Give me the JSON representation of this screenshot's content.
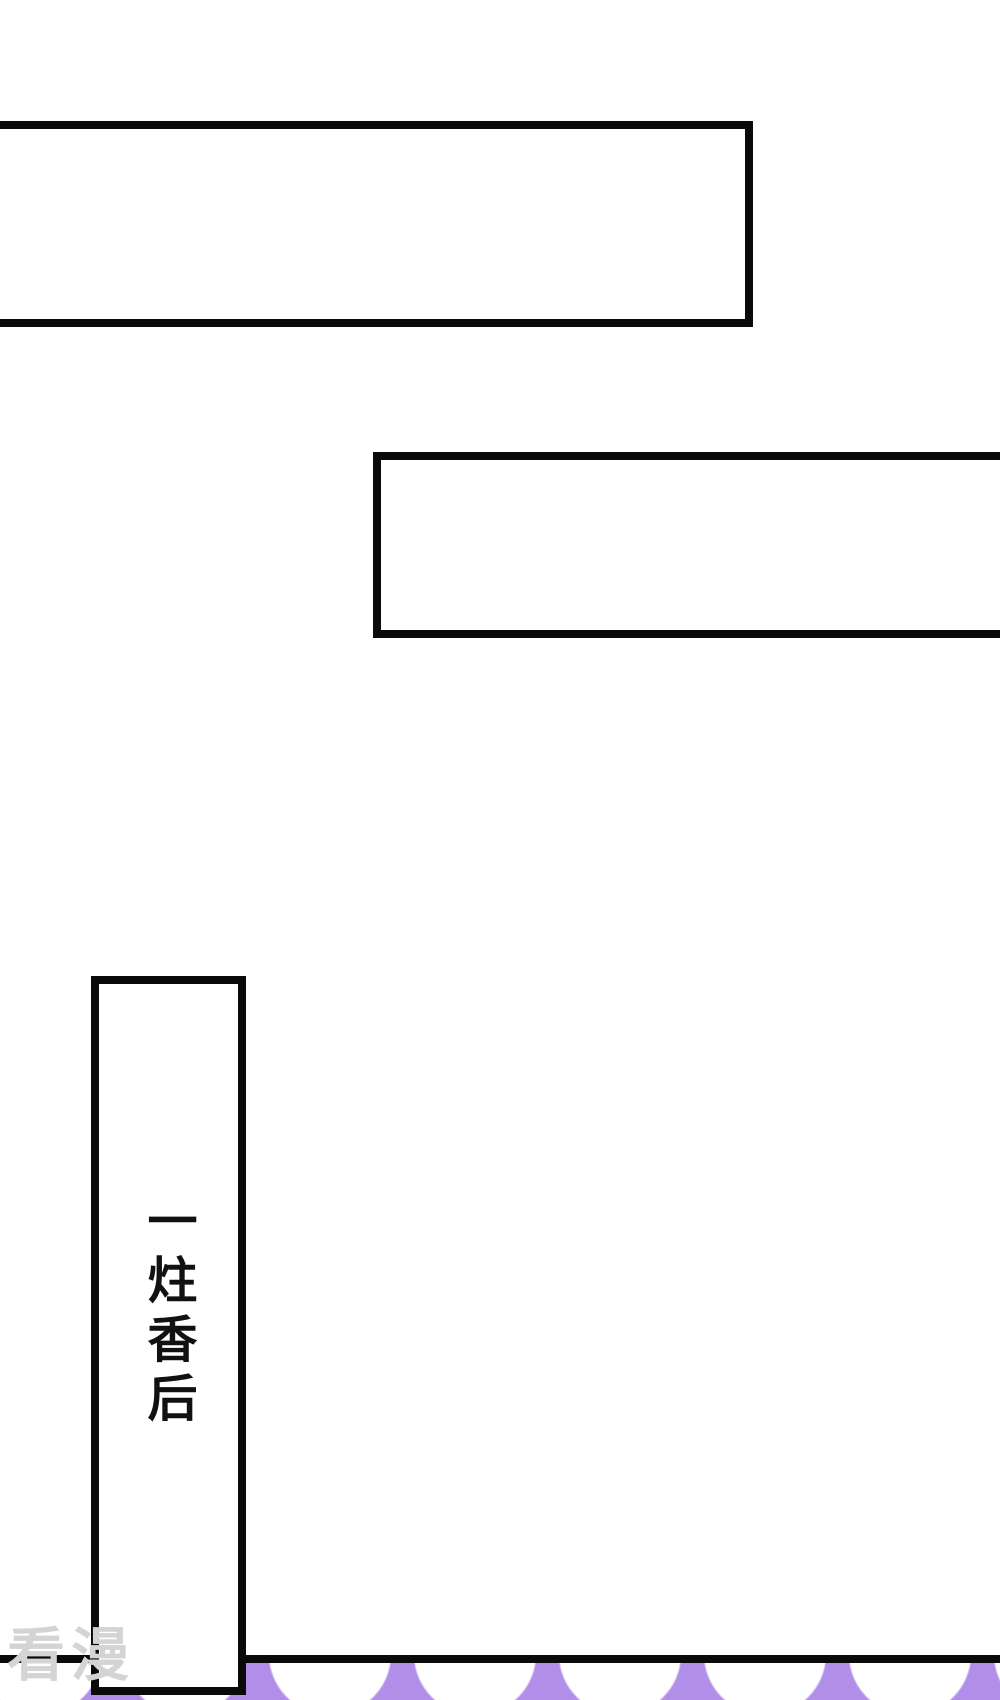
{
  "page": {
    "background_color": "#ffffff",
    "ink_color": "#0a0a0a"
  },
  "captions": {
    "top_box_text": "",
    "middle_box_text": "",
    "vertical_box_text": "一炷香后"
  },
  "watermark": {
    "text": "看漫",
    "color": "#d4d4d4"
  },
  "panel_edge": {
    "scallop_color": "#b18fe9",
    "scallop_hole_color": "#ffffff"
  }
}
